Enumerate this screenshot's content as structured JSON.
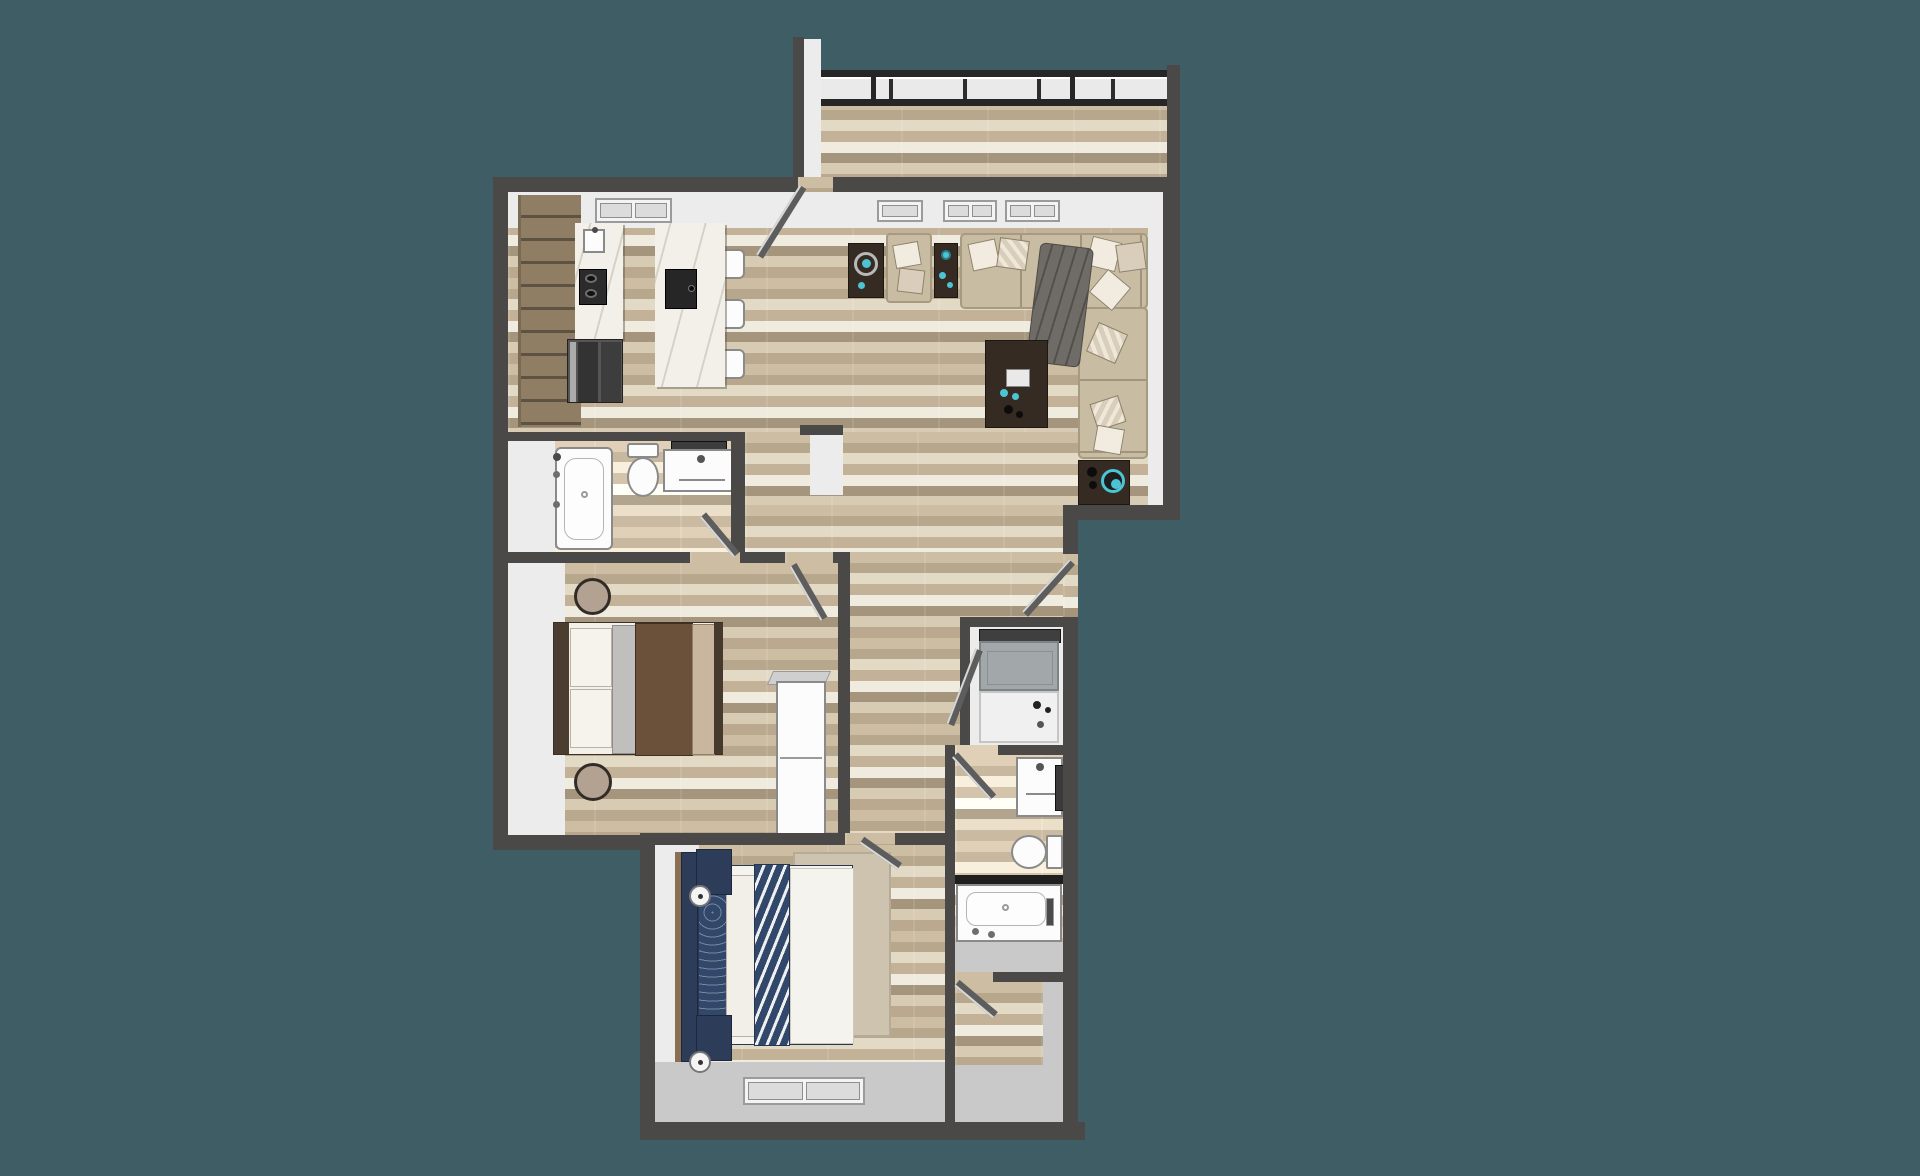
{
  "page": {
    "description": "3D top-down rendering of a two-bedroom, two-bathroom apartment floor plan with balcony, centered on a solid teal background. No visible text anywhere in the image.",
    "visible_text": ""
  },
  "palette": {
    "background": "#3e5d64",
    "wall": "#4a4947",
    "wall_dark": "#2b2b2b",
    "wall_face": "#ececec",
    "wall_face_shadow": "#c9c9c9",
    "wood1": "#cdbda2",
    "wood2": "#b7a78c",
    "wood3": "#e3dac6",
    "wood4": "#c3b297",
    "wood5": "#f0ebdf",
    "wood6": "#a4957c",
    "wood7": "#d8cbb3",
    "wood8": "#baa98e",
    "cabinet": "#8f7d64",
    "cabinet_dark": "#5e5243",
    "marble": "#f3f0e9",
    "sofa": "#c8bca2",
    "sofa_line": "#a69a80",
    "pillow_light": "#f1ecdf",
    "pillow_tan": "#d8cebb",
    "throw": "#6f6b66",
    "table_dark": "#362b22",
    "teal_accent": "#4cc4d4",
    "navy": "#31486b",
    "navy_dark": "#2c3c59",
    "rug": "#cdc3af",
    "fixture_white": "#fcfcfc",
    "fixture_edge": "#8a8a8a",
    "tile_gray": "#c6c6c6",
    "appliance_gray": "#a2a7aa",
    "bed1_brown": "#6b5139",
    "bed1_tan": "#c8b79e",
    "headboard_brown": "#4b3e31",
    "stool": "#b3a292",
    "door": "#5d5d5d"
  },
  "floor_plan": {
    "type": "3d-top-down-apartment",
    "rooms": [
      {
        "name": "balcony",
        "floor": "wood-plank",
        "features": [
          "glass-railing-panels",
          "railing-posts",
          "side-walls"
        ]
      },
      {
        "name": "kitchen",
        "floor": "wood-plank",
        "features": [
          "wall-cabinet-run",
          "counter-sink",
          "black-cooktop",
          "refrigerator",
          "marble-island-with-sink",
          "three-barstools",
          "window"
        ]
      },
      {
        "name": "living-room",
        "floor": "wood-plank",
        "features": [
          "l-shaped-sectional-sofa",
          "throw-pillows",
          "gray-throw-blanket",
          "armchair",
          "side-table-with-ring-tray",
          "side-table-with-decor",
          "coffee-table",
          "speaker-side-table",
          "three-windows",
          "balcony-door"
        ]
      },
      {
        "name": "bathroom-1",
        "floor": "wood-plank",
        "features": [
          "bathtub",
          "toilet",
          "vanity-sink",
          "mirror",
          "swing-door"
        ]
      },
      {
        "name": "bedroom-1",
        "floor": "wood-plank",
        "features": [
          "bed-brown-bedding",
          "two-round-stools",
          "white-dresser",
          "swing-door"
        ]
      },
      {
        "name": "hallway-entry",
        "floor": "wood-plank",
        "features": [
          "entry-door"
        ]
      },
      {
        "name": "laundry-closet",
        "floor": "gray",
        "features": [
          "washer",
          "dryer",
          "swing-door"
        ]
      },
      {
        "name": "bathroom-2",
        "floor": "wood-plank-and-gray-tile",
        "features": [
          "vanity-sink",
          "mirror",
          "toilet",
          "bathtub",
          "swing-door"
        ]
      },
      {
        "name": "walk-in-closet",
        "floor": "wood-plank",
        "features": [
          "swing-door"
        ]
      },
      {
        "name": "bedroom-2-master",
        "floor": "wood-plank",
        "features": [
          "bed-navy-chevron-bedding",
          "navy-headboard",
          "two-navy-nightstands",
          "two-round-lamps",
          "area-rug",
          "window-on-south-wall",
          "swing-door"
        ]
      }
    ]
  }
}
